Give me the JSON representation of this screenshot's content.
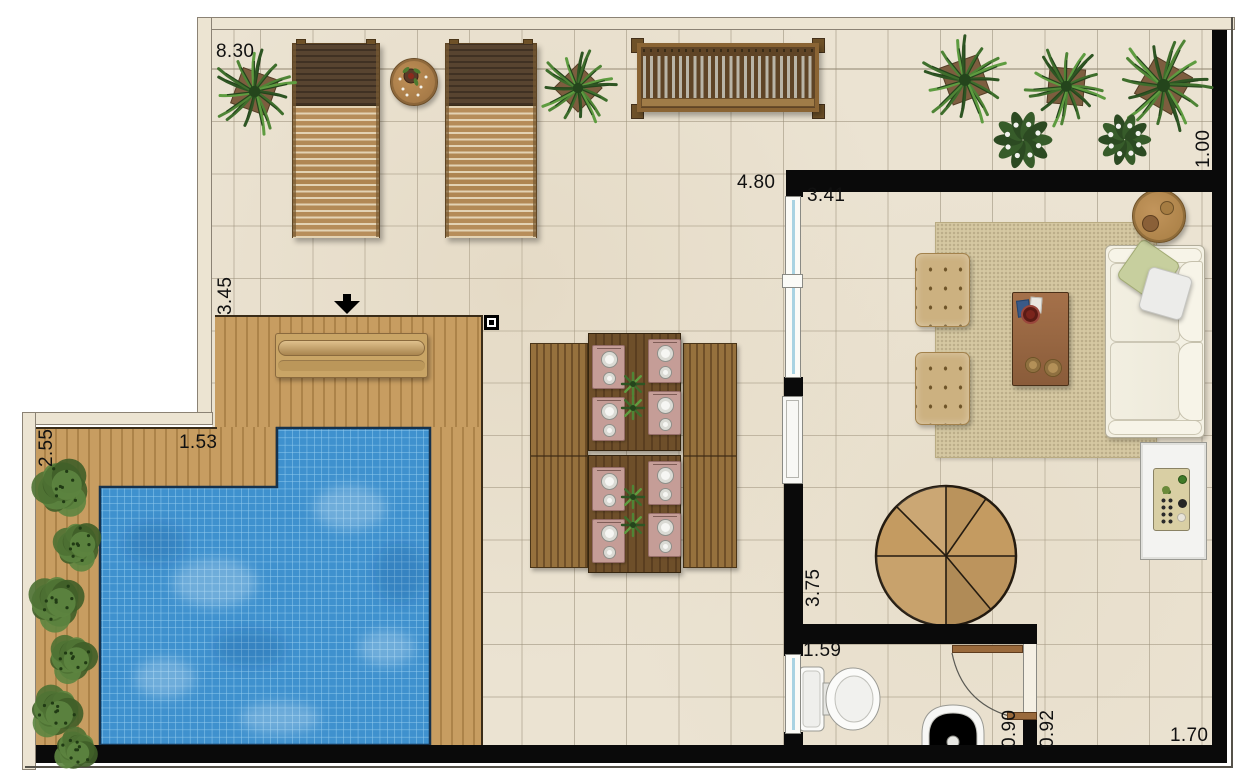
{
  "plan": {
    "dimensions": {
      "top_width": "8.30",
      "right_offset": "1.00",
      "terrace_opening": "4.80",
      "living_width": "3.41",
      "deck_height": "3.45",
      "pool_side": "2.55",
      "deck_strip": "1.53",
      "living_height": "3.75",
      "bathroom_width": "1.59",
      "bathroom_door": "0.90",
      "passage_width": "0.92",
      "terrace_corner": "1.70"
    },
    "palette": {
      "wall": "#0a0a0a",
      "tile": "#ebe3d2",
      "tile_grid": "#b5ac99",
      "deck": "#c79d61",
      "deck_line": "#a5804a",
      "pool_water": "#3d8ecb",
      "pool_tile_line": "#9fd3ef",
      "hedge": "#4e7133",
      "border_fill": "#ece4d2",
      "border_line": "#8b8274",
      "label_color": "#111111",
      "glass": "#a9d3e2",
      "door_wood": "#9a6a3c",
      "rug": "#d5c8a2",
      "sofa": "#f4f1e4",
      "stair_wood": "#c49b61"
    },
    "icons": {
      "entry_arrow": "down-arrow",
      "column_marker": "square-dot"
    }
  }
}
